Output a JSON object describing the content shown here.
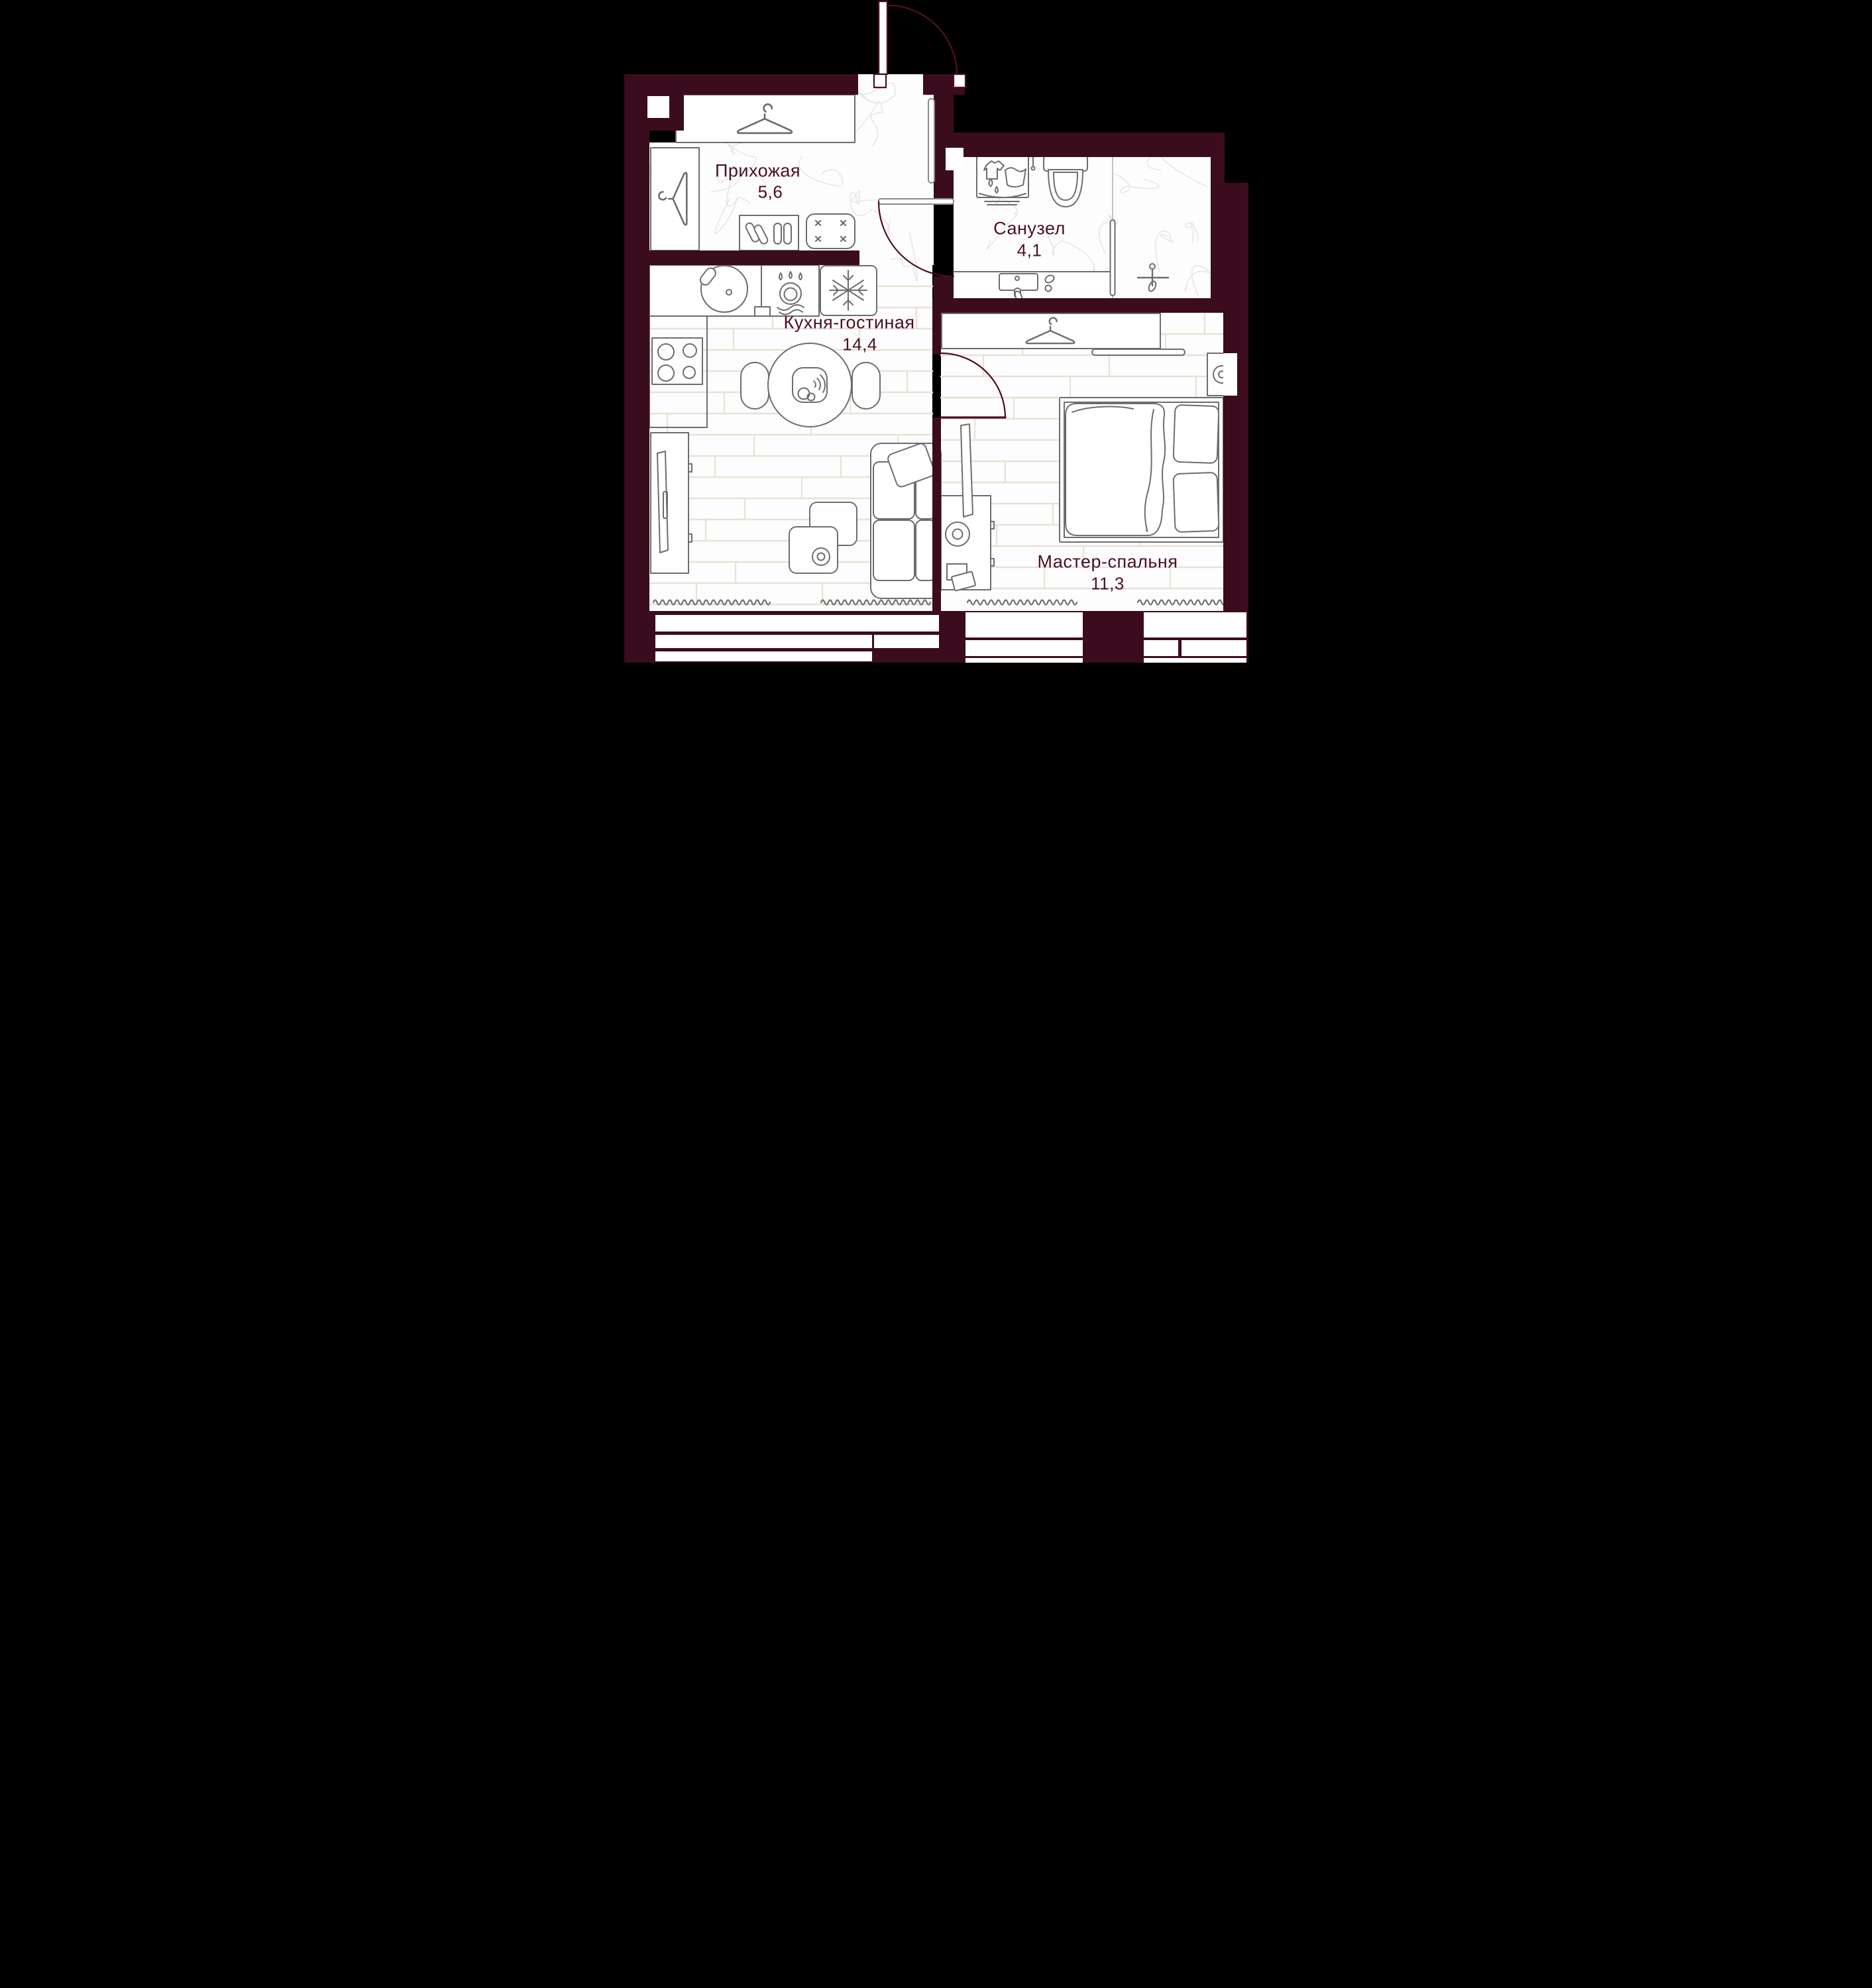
{
  "meta": {
    "type": "apartment-floor-plan",
    "language": "ru"
  },
  "palette": {
    "page_background": "#000000",
    "wall": "#3b0c1d",
    "door_arc": "#4b0f22",
    "label_text": "#4b0f22",
    "furniture_line": "#6d6d6d",
    "plank_seam": "#e8e1d6",
    "marble_vein": "#e6e6e6"
  },
  "rooms": [
    {
      "id": "hallway",
      "name": "Прихожая",
      "area": "5,6"
    },
    {
      "id": "bathroom",
      "name": "Санузел",
      "area": "4,1"
    },
    {
      "id": "kitchen_living",
      "name": "Кухня-гостиная",
      "area": "14,4"
    },
    {
      "id": "master_bedroom",
      "name": "Мастер-спальня",
      "area": "11,3"
    }
  ],
  "fixtures": [
    "entry-door",
    "coat-closet-hanger",
    "wardrobe-hanger",
    "shoe-cabinet",
    "pouf",
    "washing-machine",
    "toilet",
    "bathroom-sink",
    "shower",
    "glass-partition",
    "kitchen-sink",
    "dishwasher",
    "fridge",
    "stove",
    "dining-table",
    "chairs",
    "serving-plate",
    "sofa",
    "pillow",
    "coffee-tables",
    "tv-console",
    "tv-panel",
    "double-bed",
    "duvet",
    "pillows",
    "nightstand",
    "table-lamp",
    "dresser",
    "books",
    "radiators",
    "facade-windows"
  ]
}
